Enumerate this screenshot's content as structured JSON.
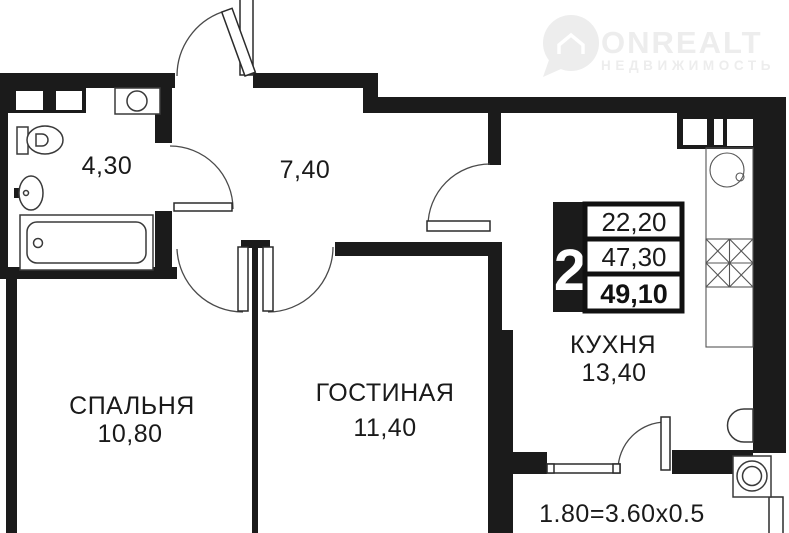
{
  "plan": {
    "logo": {
      "title": "ONREALT",
      "subtitle": "НЕДВИЖИМОСТЬ"
    },
    "summary": {
      "rooms": "2",
      "values": [
        "22,20",
        "47,30",
        "49,10"
      ]
    },
    "labels": {
      "bathroom_area": "4,30",
      "hall_area": "7,40",
      "bedroom_name": "СПАЛЬНЯ",
      "bedroom_area": "10,80",
      "living_name": "ГОСТИНАЯ",
      "living_area": "11,40",
      "kitchen_name": "КУХНЯ",
      "kitchen_area": "13,40",
      "balcony_formula": "1.80=3.60x0.5"
    },
    "colors": {
      "wall": "#1b1b1b",
      "text": "#1a1a1a",
      "watermark": "#ededed",
      "background": "#ffffff"
    }
  }
}
